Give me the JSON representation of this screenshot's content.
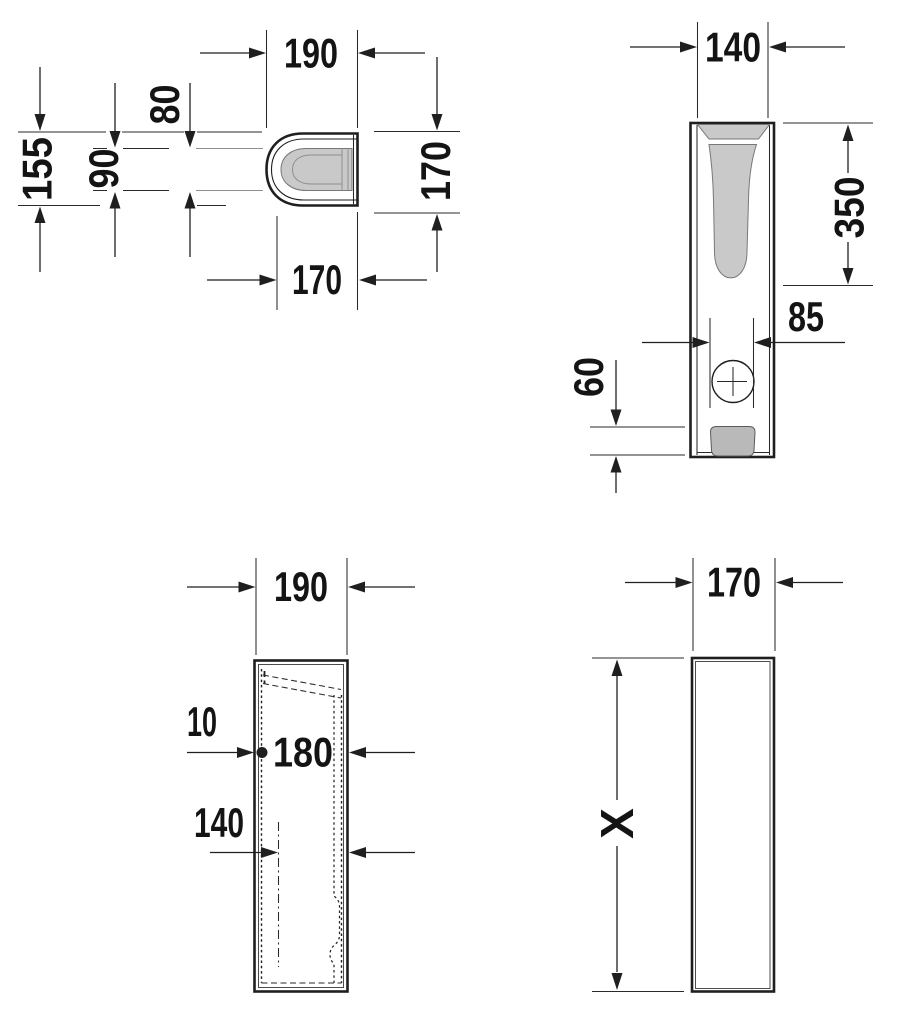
{
  "drawing": {
    "type": "technical-dimension-drawing",
    "colors": {
      "background": "#ffffff",
      "line": "#1f1f1f",
      "basin_gray": "#c9c9c9",
      "drain_gray": "#b9b9b9",
      "thin_gray": "#8f8f8f"
    },
    "views": {
      "plan": {
        "label": "plan-view",
        "dims": {
          "top_width": "190",
          "rim_depth": "80",
          "rim_width": "90",
          "body_depth": "155",
          "side_height": "170",
          "bottom_width": "170"
        }
      },
      "front": {
        "label": "front-view",
        "dims": {
          "top_width": "140",
          "basin_depth": "350",
          "drain_width": "85",
          "outlet_height": "60"
        }
      },
      "section": {
        "label": "section-view",
        "dims": {
          "top_width": "190",
          "wall_offset": "10",
          "inner_width": "180",
          "channel_width": "140"
        }
      },
      "profile": {
        "label": "profile-view",
        "dims": {
          "top_width": "170",
          "height": "X"
        }
      }
    }
  }
}
